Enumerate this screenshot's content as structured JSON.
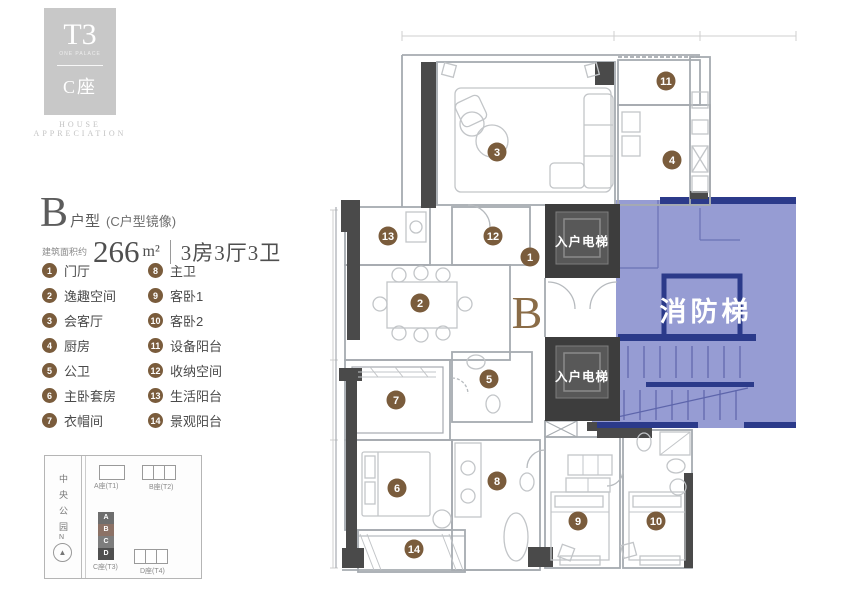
{
  "brand": {
    "logo_main": "T3",
    "logo_sub": "ONE PALACE",
    "logo_block": "C座",
    "tagline_line1": "HOUSE",
    "tagline_line2": "APPRECIATION"
  },
  "title": {
    "unit_letter": "B",
    "unit_type": "户型",
    "mirror_note": "(C户型镜像)",
    "area_label": "建筑面积约",
    "area_value": "266",
    "area_unit": "m²",
    "rooms_text": "3房3厅3卫"
  },
  "legend": {
    "items": [
      {
        "num": "1",
        "label": "门厅"
      },
      {
        "num": "2",
        "label": "逸趣空间"
      },
      {
        "num": "3",
        "label": "会客厅"
      },
      {
        "num": "4",
        "label": "厨房"
      },
      {
        "num": "5",
        "label": "公卫"
      },
      {
        "num": "6",
        "label": "主卧套房"
      },
      {
        "num": "7",
        "label": "衣帽间"
      },
      {
        "num": "8",
        "label": "主卫"
      },
      {
        "num": "9",
        "label": "客卧1"
      },
      {
        "num": "10",
        "label": "客卧2"
      },
      {
        "num": "11",
        "label": "设备阳台"
      },
      {
        "num": "12",
        "label": "收纳空间"
      },
      {
        "num": "13",
        "label": "生活阳台"
      },
      {
        "num": "14",
        "label": "景观阳台"
      }
    ]
  },
  "plan": {
    "unit_mark": "B",
    "elevator_top": "入户电梯",
    "elevator_bottom": "入户电梯",
    "fire_stair": "消防梯",
    "markers": [
      {
        "num": "1",
        "x": 530,
        "y": 257
      },
      {
        "num": "2",
        "x": 420,
        "y": 303
      },
      {
        "num": "3",
        "x": 497,
        "y": 152
      },
      {
        "num": "4",
        "x": 672,
        "y": 160
      },
      {
        "num": "5",
        "x": 489,
        "y": 379
      },
      {
        "num": "6",
        "x": 397,
        "y": 488
      },
      {
        "num": "7",
        "x": 396,
        "y": 400
      },
      {
        "num": "8",
        "x": 497,
        "y": 481
      },
      {
        "num": "9",
        "x": 578,
        "y": 521
      },
      {
        "num": "10",
        "x": 656,
        "y": 521
      },
      {
        "num": "11",
        "x": 666,
        "y": 81
      },
      {
        "num": "12",
        "x": 493,
        "y": 236
      },
      {
        "num": "13",
        "x": 388,
        "y": 236
      },
      {
        "num": "14",
        "x": 414,
        "y": 549
      }
    ]
  },
  "siteplan": {
    "park": "中央公园",
    "north": "N",
    "building_a": "A座(T1)",
    "building_b": "B座(T2)",
    "building_c": "C座(T3)",
    "building_d": "D座(T4)",
    "stack": [
      "A",
      "B",
      "C",
      "D"
    ]
  },
  "colors": {
    "marker": "#7a5c3c",
    "accent_blue": "#8d94cf",
    "navy": "#2b3a8a",
    "wall_dark": "#4a4a4a"
  }
}
